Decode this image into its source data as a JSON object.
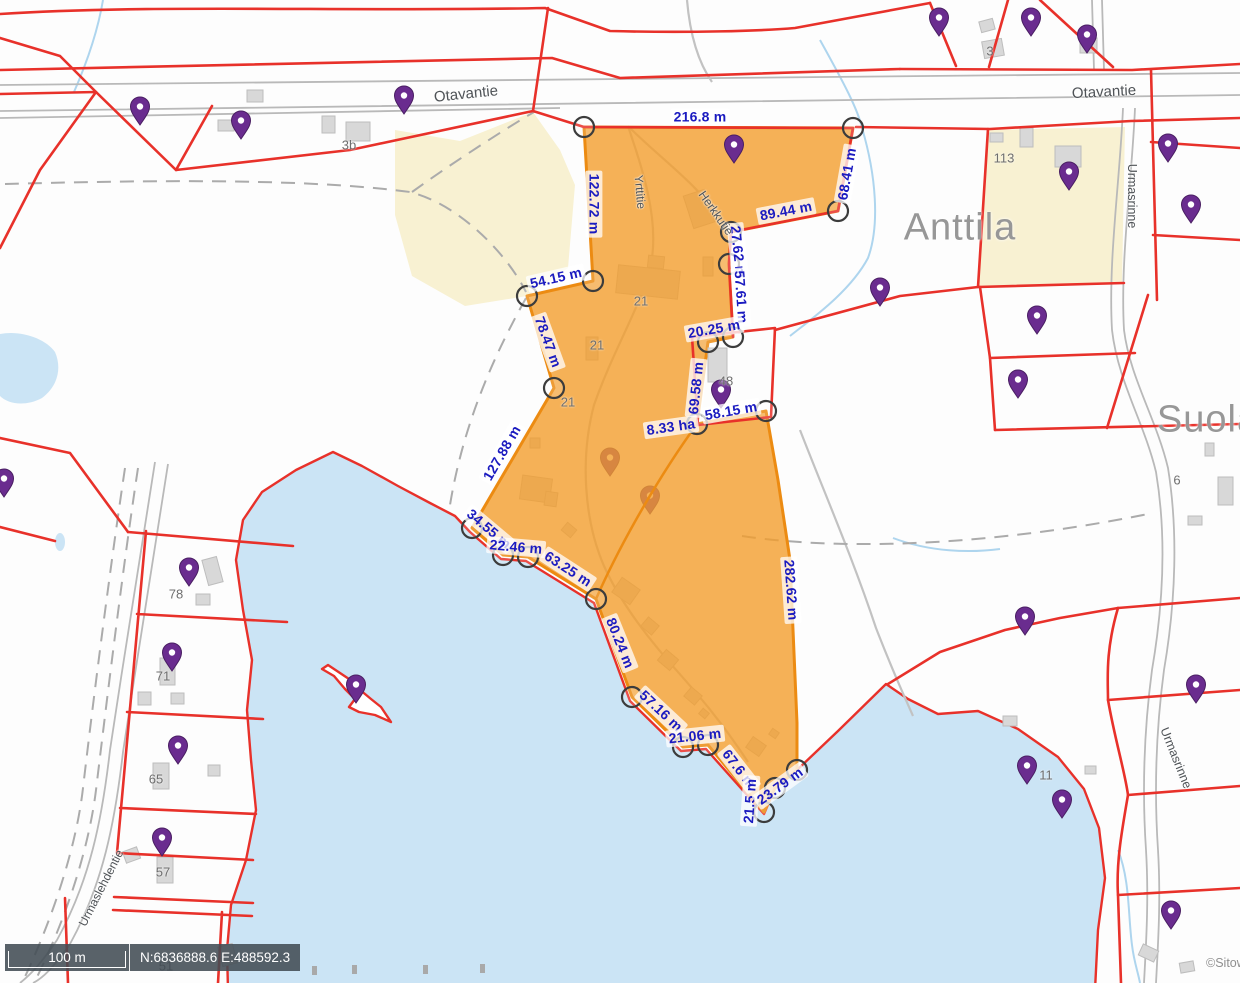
{
  "colors": {
    "highlight_fill": "#f29e2d",
    "highlight_edge": "#ec8b12",
    "boundary_red": "#e8312a",
    "water": "#cbe4f5",
    "measure_blue": "#1b1bc0",
    "pin_purple": "#6a2c8f",
    "label_bg": "rgba(255,255,255,0.75)"
  },
  "measurements": [
    {
      "text": "216.8 m",
      "x": 700,
      "y": 117,
      "rot": 0
    },
    {
      "text": "122.72 m",
      "x": 594,
      "y": 204,
      "rot": 90
    },
    {
      "text": "68.41 m",
      "x": 847,
      "y": 174,
      "rot": -80
    },
    {
      "text": "89.44 m",
      "x": 786,
      "y": 211,
      "rot": -11
    },
    {
      "text": "27.62 m",
      "x": 738,
      "y": 252,
      "rot": 84
    },
    {
      "text": "57.61 m",
      "x": 741,
      "y": 297,
      "rot": 86
    },
    {
      "text": "54.15 m",
      "x": 556,
      "y": 278,
      "rot": -13
    },
    {
      "text": "78.47 m",
      "x": 548,
      "y": 342,
      "rot": 70
    },
    {
      "text": "20.25 m",
      "x": 714,
      "y": 329,
      "rot": -10
    },
    {
      "text": "69.58 m",
      "x": 696,
      "y": 388,
      "rot": -84
    },
    {
      "text": "58.15 m",
      "x": 731,
      "y": 411,
      "rot": -10
    },
    {
      "text": "8.33 ha",
      "x": 671,
      "y": 427,
      "rot": -8
    },
    {
      "text": "127.88 m",
      "x": 502,
      "y": 453,
      "rot": -60
    },
    {
      "text": "34.55 m",
      "x": 489,
      "y": 529,
      "rot": 40
    },
    {
      "text": "22.46 m",
      "x": 516,
      "y": 547,
      "rot": 5
    },
    {
      "text": "63.25 m",
      "x": 568,
      "y": 569,
      "rot": 33
    },
    {
      "text": "80.24 m",
      "x": 620,
      "y": 643,
      "rot": 68
    },
    {
      "text": "57.16 m",
      "x": 661,
      "y": 711,
      "rot": 43
    },
    {
      "text": "21.06 m",
      "x": 695,
      "y": 736,
      "rot": -6
    },
    {
      "text": "67.6 m",
      "x": 739,
      "y": 769,
      "rot": 52
    },
    {
      "text": "21.5 m",
      "x": 750,
      "y": 801,
      "rot": -86
    },
    {
      "text": "23.79 m",
      "x": 780,
      "y": 786,
      "rot": -36
    },
    {
      "text": "282.62 m",
      "x": 791,
      "y": 590,
      "rot": 86
    }
  ],
  "street_labels": [
    {
      "text": "Otavantie",
      "x": 466,
      "y": 94,
      "rot": -6,
      "size": 15
    },
    {
      "text": "Otavantie",
      "x": 1104,
      "y": 92,
      "rot": -3,
      "size": 15
    },
    {
      "text": "Urmasrinne",
      "x": 1132,
      "y": 196,
      "rot": 90,
      "size": 12.5
    },
    {
      "text": "Urmasrinne",
      "x": 1176,
      "y": 758,
      "rot": 68,
      "size": 12.5
    },
    {
      "text": "Yrttitie",
      "x": 640,
      "y": 192,
      "rot": 85,
      "size": 12
    },
    {
      "text": "Herkkutie",
      "x": 716,
      "y": 213,
      "rot": 55,
      "size": 12
    },
    {
      "text": "Urmaslehdentie",
      "x": 101,
      "y": 888,
      "rot": -63,
      "size": 12
    }
  ],
  "place_labels": [
    {
      "text": "Anttila",
      "x": 960,
      "y": 228,
      "size": 38
    },
    {
      "text": "Suola",
      "x": 1208,
      "y": 420,
      "size": 38
    }
  ],
  "house_numbers": [
    {
      "text": "3b",
      "x": 349,
      "y": 145
    },
    {
      "text": "3",
      "x": 990,
      "y": 51
    },
    {
      "text": "113",
      "x": 1004,
      "y": 158
    },
    {
      "text": "21",
      "x": 641,
      "y": 301
    },
    {
      "text": "21",
      "x": 597,
      "y": 345
    },
    {
      "text": "21",
      "x": 568,
      "y": 402
    },
    {
      "text": "48",
      "x": 726,
      "y": 381
    },
    {
      "text": "6",
      "x": 1177,
      "y": 480
    },
    {
      "text": "78",
      "x": 176,
      "y": 594
    },
    {
      "text": "71",
      "x": 163,
      "y": 676
    },
    {
      "text": "65",
      "x": 156,
      "y": 779
    },
    {
      "text": "57",
      "x": 163,
      "y": 872
    },
    {
      "text": "51",
      "x": 166,
      "y": 966
    },
    {
      "text": "11",
      "x": 1046,
      "y": 775
    }
  ],
  "pins": [
    {
      "x": 140,
      "y": 125
    },
    {
      "x": 241,
      "y": 139
    },
    {
      "x": 404,
      "y": 114
    },
    {
      "x": 734,
      "y": 163
    },
    {
      "x": 939,
      "y": 36
    },
    {
      "x": 1031,
      "y": 36
    },
    {
      "x": 1087,
      "y": 53
    },
    {
      "x": 1168,
      "y": 162
    },
    {
      "x": 1191,
      "y": 223
    },
    {
      "x": 1069,
      "y": 190
    },
    {
      "x": 880,
      "y": 306
    },
    {
      "x": 1037,
      "y": 334
    },
    {
      "x": 1018,
      "y": 398
    },
    {
      "x": 4,
      "y": 497
    },
    {
      "x": 610,
      "y": 476,
      "muted": true
    },
    {
      "x": 650,
      "y": 514,
      "muted": true
    },
    {
      "x": 721,
      "y": 408
    },
    {
      "x": 189,
      "y": 586
    },
    {
      "x": 172,
      "y": 671
    },
    {
      "x": 356,
      "y": 703
    },
    {
      "x": 178,
      "y": 764
    },
    {
      "x": 1025,
      "y": 635
    },
    {
      "x": 1196,
      "y": 703
    },
    {
      "x": 162,
      "y": 856
    },
    {
      "x": 1027,
      "y": 784
    },
    {
      "x": 1062,
      "y": 818
    },
    {
      "x": 1171,
      "y": 929
    }
  ],
  "vertex_markers": [
    [
      584,
      127
    ],
    [
      853,
      128
    ],
    [
      838,
      211
    ],
    [
      731,
      232
    ],
    [
      729,
      264
    ],
    [
      733,
      337
    ],
    [
      708,
      342
    ],
    [
      697,
      424
    ],
    [
      766,
      411
    ],
    [
      554,
      388
    ],
    [
      527,
      296
    ],
    [
      593,
      281
    ],
    [
      472,
      528
    ],
    [
      503,
      555
    ],
    [
      528,
      557
    ],
    [
      596,
      599
    ],
    [
      632,
      697
    ],
    [
      683,
      747
    ],
    [
      708,
      745
    ],
    [
      764,
      812
    ],
    [
      775,
      788
    ],
    [
      797,
      770
    ]
  ],
  "buildings_land": [
    [
      247,
      90,
      16,
      12,
      0
    ],
    [
      218,
      120,
      16,
      11,
      0
    ],
    [
      322,
      116,
      13,
      17,
      0
    ],
    [
      346,
      122,
      24,
      19,
      0
    ],
    [
      980,
      20,
      14,
      11,
      -15
    ],
    [
      983,
      40,
      20,
      17,
      -10
    ],
    [
      1080,
      38,
      17,
      15,
      0
    ],
    [
      990,
      133,
      13,
      9,
      0
    ],
    [
      1020,
      128,
      13,
      19,
      0
    ],
    [
      1055,
      146,
      26,
      21,
      0
    ],
    [
      1205,
      443,
      9,
      13,
      0
    ],
    [
      1218,
      477,
      15,
      28,
      0
    ],
    [
      1188,
      516,
      14,
      9,
      0
    ],
    [
      205,
      558,
      15,
      26,
      -15
    ],
    [
      196,
      594,
      14,
      11,
      0
    ],
    [
      160,
      658,
      15,
      27,
      0
    ],
    [
      138,
      692,
      13,
      13,
      0
    ],
    [
      171,
      693,
      13,
      11,
      0
    ],
    [
      153,
      763,
      16,
      26,
      0
    ],
    [
      208,
      765,
      12,
      11,
      0
    ],
    [
      157,
      857,
      16,
      26,
      0
    ],
    [
      124,
      849,
      15,
      12,
      -20
    ],
    [
      220,
      945,
      15,
      20,
      -15
    ],
    [
      1003,
      716,
      14,
      10,
      0
    ],
    [
      1085,
      766,
      11,
      8,
      0
    ],
    [
      1140,
      947,
      17,
      12,
      25
    ],
    [
      1180,
      962,
      14,
      10,
      -10
    ],
    [
      708,
      348,
      19,
      34,
      0
    ]
  ],
  "buildings_highlight": [
    [
      617,
      268,
      62,
      28,
      6
    ],
    [
      648,
      256,
      16,
      12,
      6
    ],
    [
      688,
      192,
      22,
      34,
      -18
    ],
    [
      703,
      257,
      10,
      19,
      0
    ],
    [
      586,
      337,
      12,
      23,
      0
    ],
    [
      530,
      438,
      10,
      10,
      0
    ],
    [
      521,
      477,
      30,
      24,
      8
    ],
    [
      545,
      492,
      12,
      14,
      8
    ],
    [
      563,
      525,
      12,
      10,
      40
    ],
    [
      615,
      582,
      22,
      18,
      35
    ],
    [
      643,
      620,
      14,
      12,
      40
    ],
    [
      660,
      653,
      16,
      14,
      40
    ],
    [
      686,
      690,
      14,
      12,
      40
    ],
    [
      700,
      710,
      8,
      7,
      40
    ],
    [
      748,
      740,
      16,
      13,
      35
    ],
    [
      770,
      730,
      8,
      7,
      35
    ]
  ],
  "shore_marks": [
    [
      312,
      966
    ],
    [
      352,
      965
    ],
    [
      423,
      965
    ],
    [
      480,
      964
    ]
  ],
  "scalebar": {
    "distance_label": "100 m",
    "coordinates": "N:6836888.6 E:488592.3"
  },
  "attribution": {
    "text": "©Sitow"
  }
}
